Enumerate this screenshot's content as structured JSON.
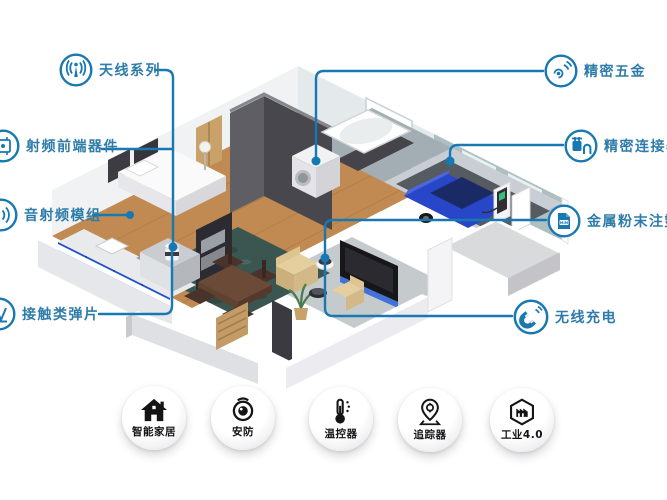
{
  "colors": {
    "accent": "#1878b2",
    "label_text": "#2e7ca9",
    "badge_text": "#141414"
  },
  "callouts": [
    {
      "id": "antenna",
      "label": "天线系列",
      "icon": "antenna-icon"
    },
    {
      "id": "rf_front_end",
      "label": "射频前端器件",
      "icon": "rf-chip-icon"
    },
    {
      "id": "audio_rf_module",
      "label": "音射频模组",
      "icon": "audio-waves-icon"
    },
    {
      "id": "contact_spring",
      "label": "接触类弹片",
      "icon": "spring-contact-icon"
    },
    {
      "id": "precision_hardware",
      "label": "精密五金",
      "icon": "coil-spiral-icon"
    },
    {
      "id": "precision_connector",
      "label": "精密连接器",
      "icon": "plug-connector-icon"
    },
    {
      "id": "mim_molding",
      "label": "金属粉末注塑成",
      "icon": "mim-document-icon",
      "icon_text": "MIM"
    },
    {
      "id": "wireless_charging",
      "label": "无线充电",
      "icon": "magnet-waves-icon"
    }
  ],
  "badges": [
    {
      "id": "smart_home",
      "label": "智能家居",
      "icon": "house-icon"
    },
    {
      "id": "security",
      "label": "安防",
      "icon": "security-camera-icon"
    },
    {
      "id": "thermostat",
      "label": "温控器",
      "icon": "thermometer-icon"
    },
    {
      "id": "tracker",
      "label": "追踪器",
      "icon": "location-pin-icon"
    },
    {
      "id": "industry_4_0",
      "label": "工业4.0",
      "icon": "factory-hexagon-icon"
    }
  ]
}
